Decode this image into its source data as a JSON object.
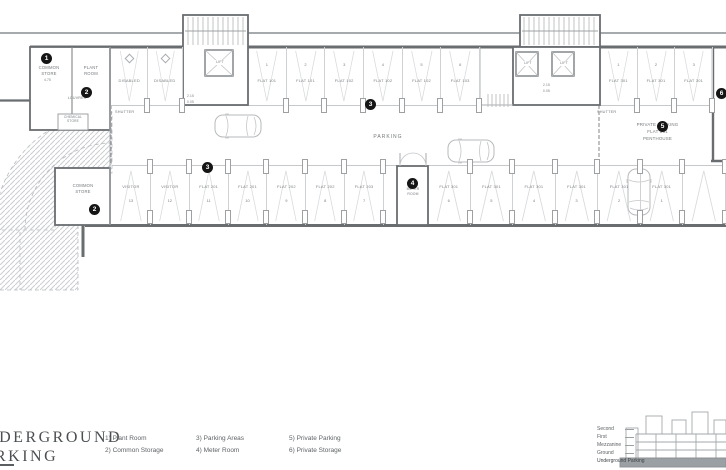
{
  "sheet": {
    "title_line1": "UNDERGROUND",
    "title_line2": "PARKING"
  },
  "legend": {
    "columns": [
      {
        "items": [
          "1) Plant Room",
          "2) Common Storage"
        ]
      },
      {
        "items": [
          "3) Parking Areas",
          "4) Meter Room"
        ]
      },
      {
        "items": [
          "5) Private Parking",
          "6) Private Storage"
        ]
      }
    ]
  },
  "level_key": {
    "labels": [
      "Second",
      "First",
      "Mezzanine",
      "Ground",
      "Underground Parking"
    ],
    "highlighted": "Underground Parking",
    "highlight_color": "#9aa0a3"
  },
  "plan": {
    "rooms": {
      "common_store_top": "COMMON STORE",
      "plant_room": "PLANT ROOM",
      "chemical_store": "CHEMICAL STORE",
      "louvres": "LOUVRES",
      "shutter": "SHUTTER",
      "parking": "PARKING",
      "meter_room": "METER ROOM",
      "common_store_bottom": "COMMON STORE",
      "private_parking_1": "PRIVATE PARKING",
      "private_parking_2": "FLAT 301",
      "private_parking_3": "PENTHOUSE",
      "lift": "LIFT",
      "level_a": "2.15",
      "level_b": "0.05",
      "level_c": "4.75"
    },
    "markers": [
      "1",
      "2",
      "2",
      "3",
      "3",
      "4",
      "5",
      "6"
    ],
    "bays": {
      "top_left": [
        {
          "num": "",
          "label": "DISABLED"
        },
        {
          "num": "",
          "label": "DISABLED"
        }
      ],
      "top_mid": [
        {
          "num": "1",
          "label": "FLAT 101"
        },
        {
          "num": "2",
          "label": "FLAT 101"
        },
        {
          "num": "3",
          "label": "FLAT 102"
        },
        {
          "num": "4",
          "label": "FLAT 102"
        },
        {
          "num": "5",
          "label": "FLAT 102"
        },
        {
          "num": "6",
          "label": "FLAT 103"
        }
      ],
      "top_right": [
        {
          "num": "1",
          "label": "FLAT 301"
        },
        {
          "num": "2",
          "label": "FLAT 301"
        },
        {
          "num": "3",
          "label": "FLAT 301"
        }
      ],
      "bottom_left": [
        {
          "num": "13",
          "label": "VISITOR"
        },
        {
          "num": "12",
          "label": "VISITOR"
        },
        {
          "num": "11",
          "label": "FLAT 201"
        },
        {
          "num": "10",
          "label": "FLAT 201"
        },
        {
          "num": "9",
          "label": "FLAT 202"
        },
        {
          "num": "8",
          "label": "FLAT 202"
        },
        {
          "num": "7",
          "label": "FLAT 203"
        }
      ],
      "bottom_right": [
        {
          "num": "6",
          "label": "FLAT 301"
        },
        {
          "num": "5",
          "label": "FLAT 301"
        },
        {
          "num": "4",
          "label": "FLAT 301"
        },
        {
          "num": "3",
          "label": "FLAT 301"
        },
        {
          "num": "2",
          "label": "FLAT 301"
        },
        {
          "num": "1",
          "label": "FLAT 301"
        },
        {
          "num": "",
          "label": ""
        }
      ]
    }
  }
}
